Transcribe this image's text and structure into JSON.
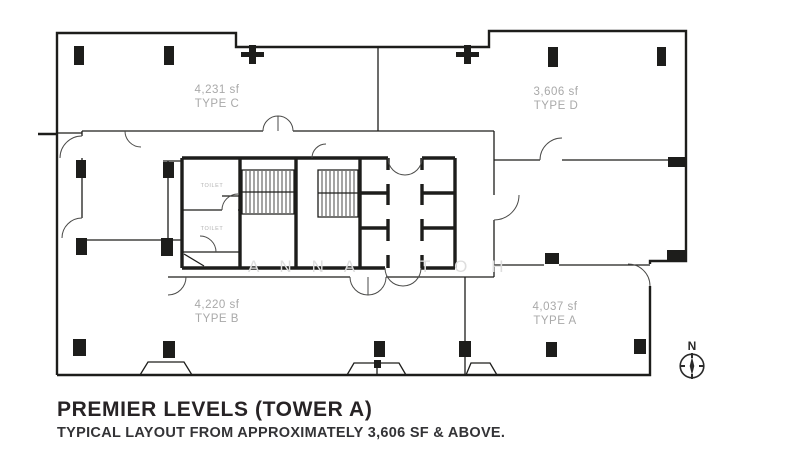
{
  "title": {
    "heading": "PREMIER LEVELS (TOWER A)",
    "subheading": "TYPICAL LAYOUT FROM APPROXIMATELY 3,606 SF & ABOVE."
  },
  "units": [
    {
      "position": "top-left",
      "area": "4,231 sf",
      "type": "TYPE C"
    },
    {
      "position": "top-right",
      "area": "3,606 sf",
      "type": "TYPE D"
    },
    {
      "position": "bottom-left",
      "area": "4,220 sf",
      "type": "TYPE B"
    },
    {
      "position": "bottom-right",
      "area": "4,037 sf",
      "type": "TYPE A"
    }
  ],
  "core": {
    "toilet_upper": "TOILET",
    "toilet_lower": "TOILET"
  },
  "compass": {
    "label": "N"
  },
  "watermark": {
    "text": "ANNA TOH",
    "part1": "ANNA",
    "part2": "TOH"
  },
  "colors": {
    "line": "#1d1d1b",
    "unit_label": "#a9a9a9",
    "title_text": "#272325",
    "watermark": "#dedede",
    "background": "#ffffff"
  }
}
